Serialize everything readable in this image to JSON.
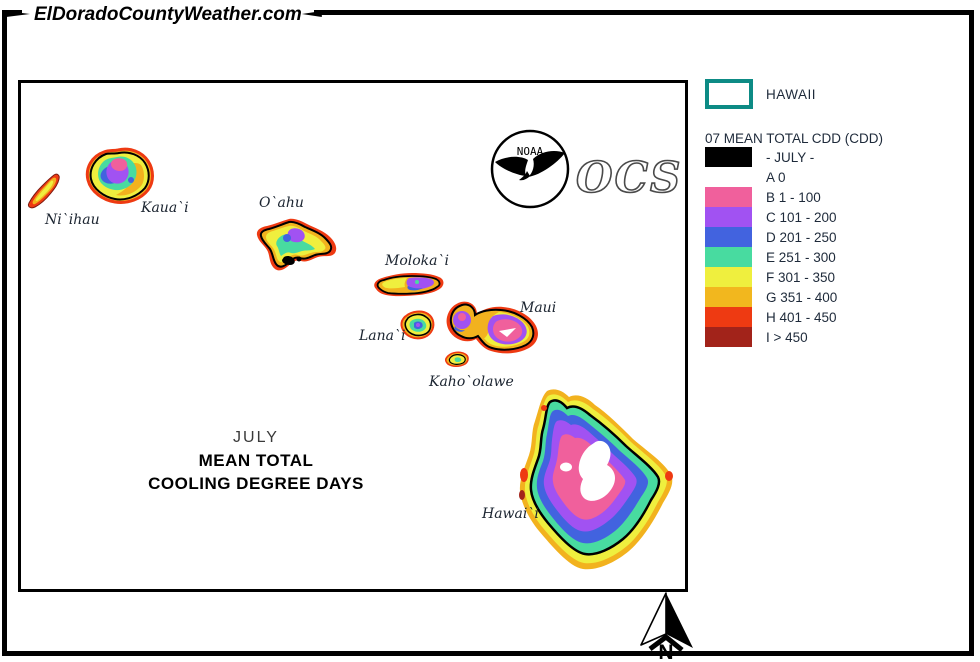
{
  "banner": {
    "site": "ElDoradoCountyWeather.com"
  },
  "map": {
    "title_line1": "JULY",
    "title_line2": "MEAN TOTAL",
    "title_line3": "COOLING DEGREE DAYS",
    "islands": {
      "niihau": "Ni`ihau",
      "kauai": "Kaua`i",
      "oahu": "O`ahu",
      "molokai": "Moloka`i",
      "lanai": "Lana`i",
      "maui": "Maui",
      "kahoolawe": "Kaho`olawe",
      "hawaii": "Hawai`i"
    },
    "logos": {
      "noaa": "NOAA",
      "ocs": "OCS"
    }
  },
  "legend": {
    "region": {
      "label": "HAWAII",
      "outline_color": "#0D8B85"
    },
    "title": "07 MEAN TOTAL CDD (CDD)",
    "items": [
      {
        "label": "- JULY -",
        "color": "#000000"
      },
      {
        "label": "A 0",
        "color": "#FFFFFF"
      },
      {
        "label": "B 1 - 100",
        "color": "#F0609C"
      },
      {
        "label": "C 101 - 200",
        "color": "#A152F2"
      },
      {
        "label": "D 201 - 250",
        "color": "#4263DF"
      },
      {
        "label": "E 251 - 300",
        "color": "#48DBA0"
      },
      {
        "label": "F 301 - 350",
        "color": "#EFEF3E"
      },
      {
        "label": "G 351 - 400",
        "color": "#F2B71E"
      },
      {
        "label": "H 401 - 450",
        "color": "#EE3A12"
      },
      {
        "label": "I > 450",
        "color": "#A2231A"
      }
    ]
  },
  "compass": {
    "label": "N"
  }
}
